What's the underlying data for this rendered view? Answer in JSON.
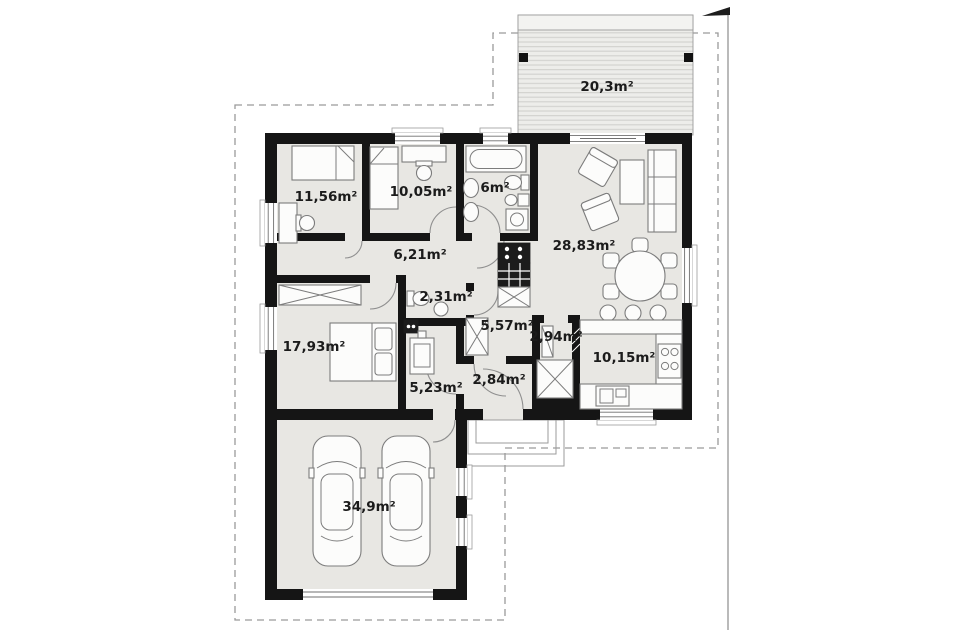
{
  "plan": {
    "type": "floor-plan",
    "rooms": {
      "terrace": {
        "name": "terrace",
        "label": "20,3m²"
      },
      "bedroom1": {
        "name": "bedroom-1",
        "label": "11,56m²"
      },
      "bedroom2": {
        "name": "bedroom-2",
        "label": "10,05m²"
      },
      "bathroom": {
        "name": "bathroom",
        "label": "6m²"
      },
      "living_room": {
        "name": "living-room",
        "label": "28,83m²"
      },
      "hallway": {
        "name": "hallway",
        "label": "6,21m²"
      },
      "toilet": {
        "name": "toilet",
        "label": "2,31m²"
      },
      "corridor": {
        "name": "corridor",
        "label": "5,57m²"
      },
      "pantry": {
        "name": "pantry",
        "label": "2,94m²"
      },
      "kitchen": {
        "name": "kitchen",
        "label": "10,15m²"
      },
      "bedroom3": {
        "name": "bedroom-3",
        "label": "17,93m²"
      },
      "utility": {
        "name": "utility-room",
        "label": "5,23m²"
      },
      "vestibule": {
        "name": "vestibule",
        "label": "2,84m²"
      },
      "garage": {
        "name": "garage",
        "label": "34,9m²"
      }
    },
    "colors": {
      "wall": "#151515",
      "floor": "#e8e7e3",
      "deck_stripe": "#d3d3d0",
      "furniture_outline": "#7c7c7c",
      "plot_boundary": "#9a9a9a"
    }
  }
}
